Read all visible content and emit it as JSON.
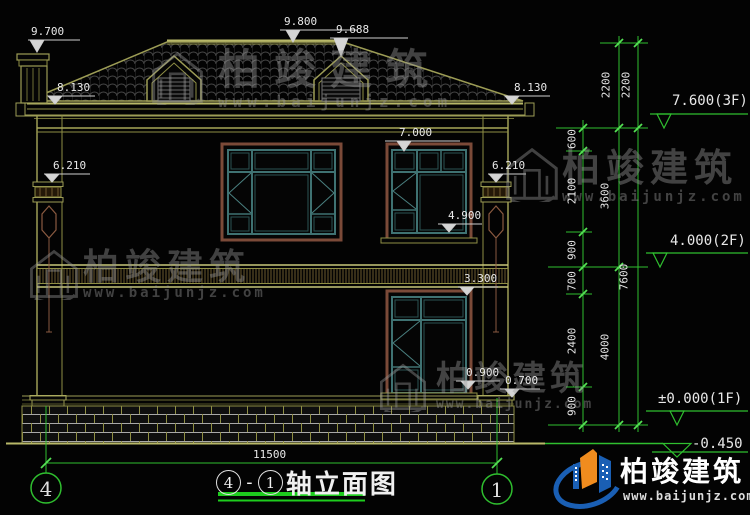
{
  "drawing": {
    "title": {
      "axis_start": "4",
      "axis_sep": "-",
      "axis_end": "1",
      "name": "轴立面图"
    },
    "axes": {
      "left": "4",
      "right": "1"
    },
    "elevations": {
      "chimney_top": "9.700",
      "ridge": "9.800",
      "dormer_top": "9.688",
      "eave_left": "8.130",
      "eave_right": "8.130",
      "window2f_head": "7.000",
      "pilaster_left": "6.210",
      "pilaster_right": "6.210",
      "window2f_sill": "4.900",
      "window1f_head": "3.300",
      "window1f_sill": "0.900",
      "pedestal_top": "0.700"
    },
    "levels": {
      "floor3": "7.600(3F)",
      "floor2": "4.000(2F)",
      "floor1": "±0.000(1F)",
      "ground": "-0.450"
    },
    "dims": {
      "fine": [
        "600",
        "2100",
        "900",
        "700",
        "2400",
        "900"
      ],
      "floors": [
        "2200",
        "3600",
        "4000"
      ],
      "totals": [
        "2200",
        "7600"
      ],
      "overall_width": "11500"
    },
    "colors": {
      "cad_line": "#9c9c55",
      "dim_green": "#2fbf2f",
      "window_frame": "#7b4a38",
      "window_sash": "#3f7272",
      "text": "#e8e8e8",
      "brand_blue": "#1a5fb4",
      "brand_orange": "#f08c1e"
    }
  },
  "brand": {
    "name": "柏竣建筑",
    "url": "www.baijunjz.com"
  }
}
